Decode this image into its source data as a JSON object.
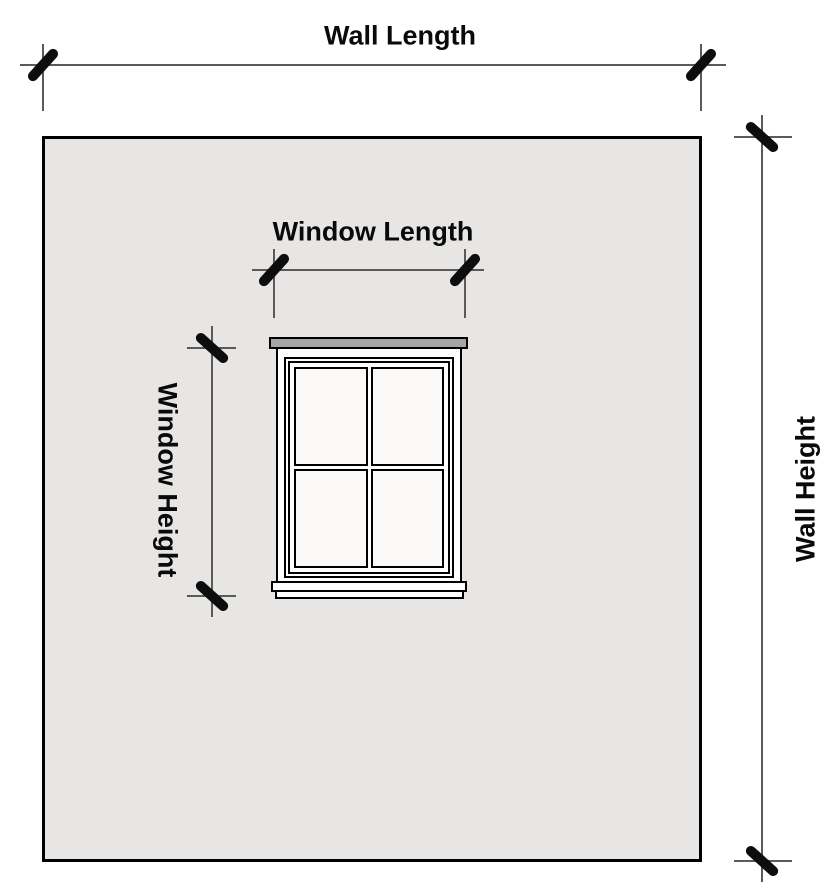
{
  "labels": {
    "wall_length": "Wall Length",
    "wall_height": "Wall Height",
    "window_length": "Window Length",
    "window_height": "Window Height"
  },
  "colors": {
    "page_bg": "#ffffff",
    "wall_fill": "#e7e6e5",
    "outline": "#000000",
    "lintel_fill": "#a6a5a4",
    "frame_fill": "#fefefe",
    "pane_fill": "#fbfaf8",
    "dim_line": "#5a5a5a",
    "tick": "#0d0d0d",
    "label_text": "#0a0a0a"
  }
}
